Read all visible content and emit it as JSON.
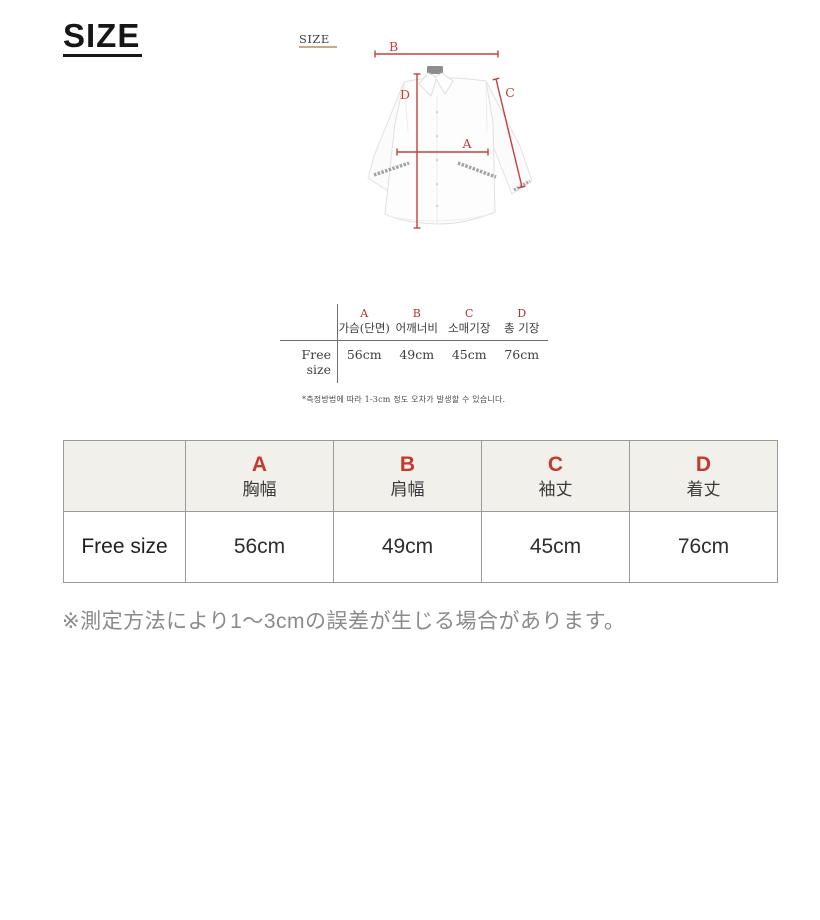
{
  "page": {
    "title": "SIZE"
  },
  "diagram": {
    "label": "SIZE",
    "markers": [
      "A",
      "B",
      "C",
      "D"
    ]
  },
  "size_table_kr": {
    "row_label": "Free size",
    "columns": [
      {
        "letter": "A",
        "label": "가슴(단면)",
        "value": "56cm"
      },
      {
        "letter": "B",
        "label": "어깨너비",
        "value": "49cm"
      },
      {
        "letter": "C",
        "label": "소매기장",
        "value": "45cm"
      },
      {
        "letter": "D",
        "label": "총 기장",
        "value": "76cm"
      }
    ],
    "note": "*측정방법에 따라 1-3cm 정도 오차가 발생할 수 있습니다."
  },
  "size_table_jp": {
    "row_label": "Free size",
    "columns": [
      {
        "letter": "A",
        "label": "胸幅",
        "value": "56cm"
      },
      {
        "letter": "B",
        "label": "肩幅",
        "value": "49cm"
      },
      {
        "letter": "C",
        "label": "袖丈",
        "value": "45cm"
      },
      {
        "letter": "D",
        "label": "着丈",
        "value": "76cm"
      }
    ],
    "note": "※測定方法により1〜3cmの誤差が生じる場合があります。"
  },
  "colors": {
    "accent_red": "#c23b2c",
    "diagram_red": "#c4403c",
    "table_header_bg": "#f2f0eb",
    "table_border": "#9a9a9a",
    "label_underline": "#b98d5f",
    "note_gray": "#8a8a8a"
  }
}
